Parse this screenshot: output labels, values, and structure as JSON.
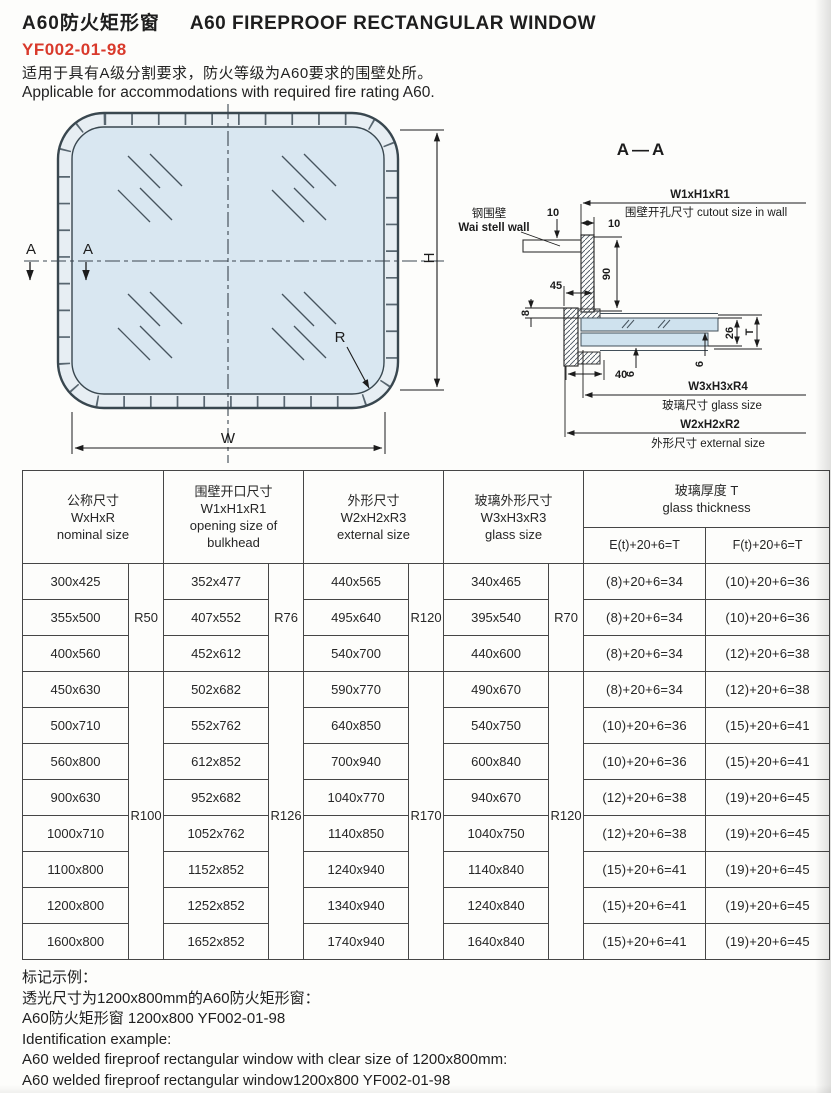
{
  "page": {
    "title_zh": "A60防火矩形窗",
    "title_en": "A60 FIREPROOF RECTANGULAR WINDOW",
    "code": "YF002-01-98",
    "desc_zh": "适用于具有A级分割要求，防火等级为A60要求的围壁处所。",
    "desc_en": "Applicable for accommodations with required fire rating A60."
  },
  "front_view": {
    "section_label_1": "A",
    "section_label_2": "A",
    "dim_h": "H",
    "dim_w": "W",
    "radius": "R"
  },
  "section_view": {
    "title": "A—A",
    "wall_zh": "钢围壁",
    "wall_en": "Wai stell wall",
    "dim_10_top": "10",
    "dim_10_side": "10",
    "dim_90": "90",
    "dim_45": "45",
    "dim_8": "8",
    "dim_40": "40",
    "dim_6_a": "6",
    "dim_6_b": "6",
    "dim_26": "26",
    "dim_t": "T",
    "cutout_code": "W1xH1xR1",
    "cutout_label": "围壁开孔尺寸 cutout size in wall",
    "glass_code": "W3xH3xR4",
    "glass_label": "玻璃尺寸 glass size",
    "external_code": "W2xH2xR2",
    "external_label": "外形尺寸 external size"
  },
  "table": {
    "headers": {
      "nominal": [
        "公称尺寸",
        "WxHxR",
        "nominal size"
      ],
      "opening": [
        "围壁开口尺寸",
        "W1xH1xR1",
        "opening size of",
        "bulkhead"
      ],
      "external": [
        "外形尺寸",
        "W2xH2xR3",
        "external size"
      ],
      "glass": [
        "玻璃外形尺寸",
        "W3xH3xR3",
        "glass size"
      ],
      "thickness": [
        "玻璃厚度  T",
        "glass thickness"
      ],
      "sub_e": "E(t)+20+6=T",
      "sub_f": "F(t)+20+6=T"
    },
    "radius_spans": [
      {
        "rows": 3,
        "nominal": "R50",
        "opening": "R76",
        "external": "R120",
        "glass": "R70"
      },
      {
        "rows": 8,
        "nominal": "R100",
        "opening": "R126",
        "external": "R170",
        "glass": "R120"
      }
    ],
    "rows": [
      [
        "300x425",
        "352x477",
        "440x565",
        "340x465",
        "(8)+20+6=34",
        "(10)+20+6=36"
      ],
      [
        "355x500",
        "407x552",
        "495x640",
        "395x540",
        "(8)+20+6=34",
        "(10)+20+6=36"
      ],
      [
        "400x560",
        "452x612",
        "540x700",
        "440x600",
        "(8)+20+6=34",
        "(12)+20+6=38"
      ],
      [
        "450x630",
        "502x682",
        "590x770",
        "490x670",
        "(8)+20+6=34",
        "(12)+20+6=38"
      ],
      [
        "500x710",
        "552x762",
        "640x850",
        "540x750",
        "(10)+20+6=36",
        "(15)+20+6=41"
      ],
      [
        "560x800",
        "612x852",
        "700x940",
        "600x840",
        "(10)+20+6=36",
        "(15)+20+6=41"
      ],
      [
        "900x630",
        "952x682",
        "1040x770",
        "940x670",
        "(12)+20+6=38",
        "(19)+20+6=45"
      ],
      [
        "1000x710",
        "1052x762",
        "1140x850",
        "1040x750",
        "(12)+20+6=38",
        "(19)+20+6=45"
      ],
      [
        "1100x800",
        "1152x852",
        "1240x940",
        "1140x840",
        "(15)+20+6=41",
        "(19)+20+6=45"
      ],
      [
        "1200x800",
        "1252x852",
        "1340x940",
        "1240x840",
        "(15)+20+6=41",
        "(19)+20+6=45"
      ],
      [
        "1600x800",
        "1652x852",
        "1740x940",
        "1640x840",
        "(15)+20+6=41",
        "(19)+20+6=45"
      ]
    ]
  },
  "footer": {
    "lines": [
      "标记示例：",
      "透光尺寸为1200x800mm的A60防火矩形窗：",
      "A60防火矩形窗  1200x800 YF002-01-98",
      "Identification example:",
      "A60 welded fireproof rectangular window with clear size of 1200x800mm:",
      "A60 welded fireproof rectangular window1200x800 YF002-01-98"
    ]
  },
  "colors": {
    "accent_red": "#d93a2c",
    "glass_fill": "#d9e7f1",
    "frame_fill": "#e7eef3",
    "line": "#3b4650"
  }
}
